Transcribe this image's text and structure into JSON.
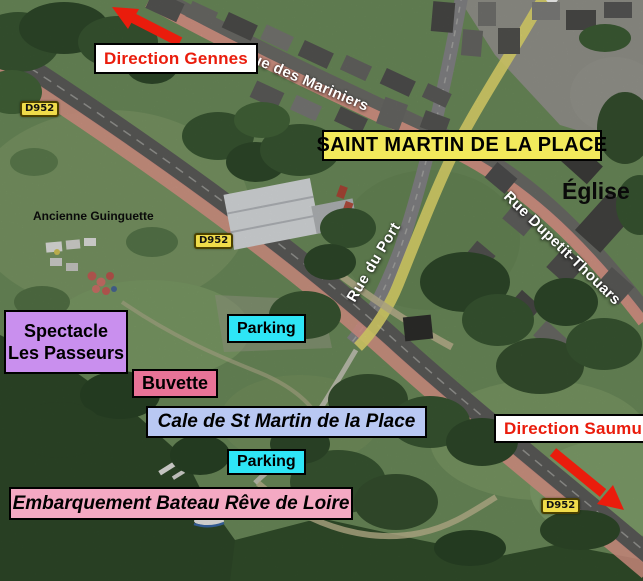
{
  "map": {
    "town_label": "SAINT MARTIN DE LA PLACE",
    "direction_labels": {
      "gennes": "Direction Gennes",
      "saumur": "Direction Saumur"
    },
    "street_labels": {
      "rue_des_mariniers": "Rue des Mariniers",
      "rue_du_port": "Rue du Port",
      "rue_dupetit_thouars": "Rue Dupetit-Thouars"
    },
    "road_badge": "D952",
    "place_labels": {
      "eglise": "Église",
      "ancienne_guinguette": "Ancienne Guinguette"
    },
    "poi_labels": {
      "spectacle_line1": "Spectacle",
      "spectacle_line2": "Les Passeurs",
      "parking": "Parking",
      "buvette": "Buvette",
      "cale": "Cale de St Martin de la Place",
      "embarquement": "Embarquement Bateau Rêve de Loire"
    },
    "colors": {
      "label_red": "#ea1c0c",
      "arrow_red": "#ea1c0c",
      "highlight_yellow": "#f2e95c",
      "badge_yellow": "#f0dc4a",
      "violet": "#c98fee",
      "cyan": "#2ee5f6",
      "pink_dark": "#e87397",
      "pink_light": "#f4a9c3",
      "periwinkle": "#b9c8f3",
      "road_pink": "#e59a8d",
      "road_yellow": "#e9e070"
    }
  }
}
